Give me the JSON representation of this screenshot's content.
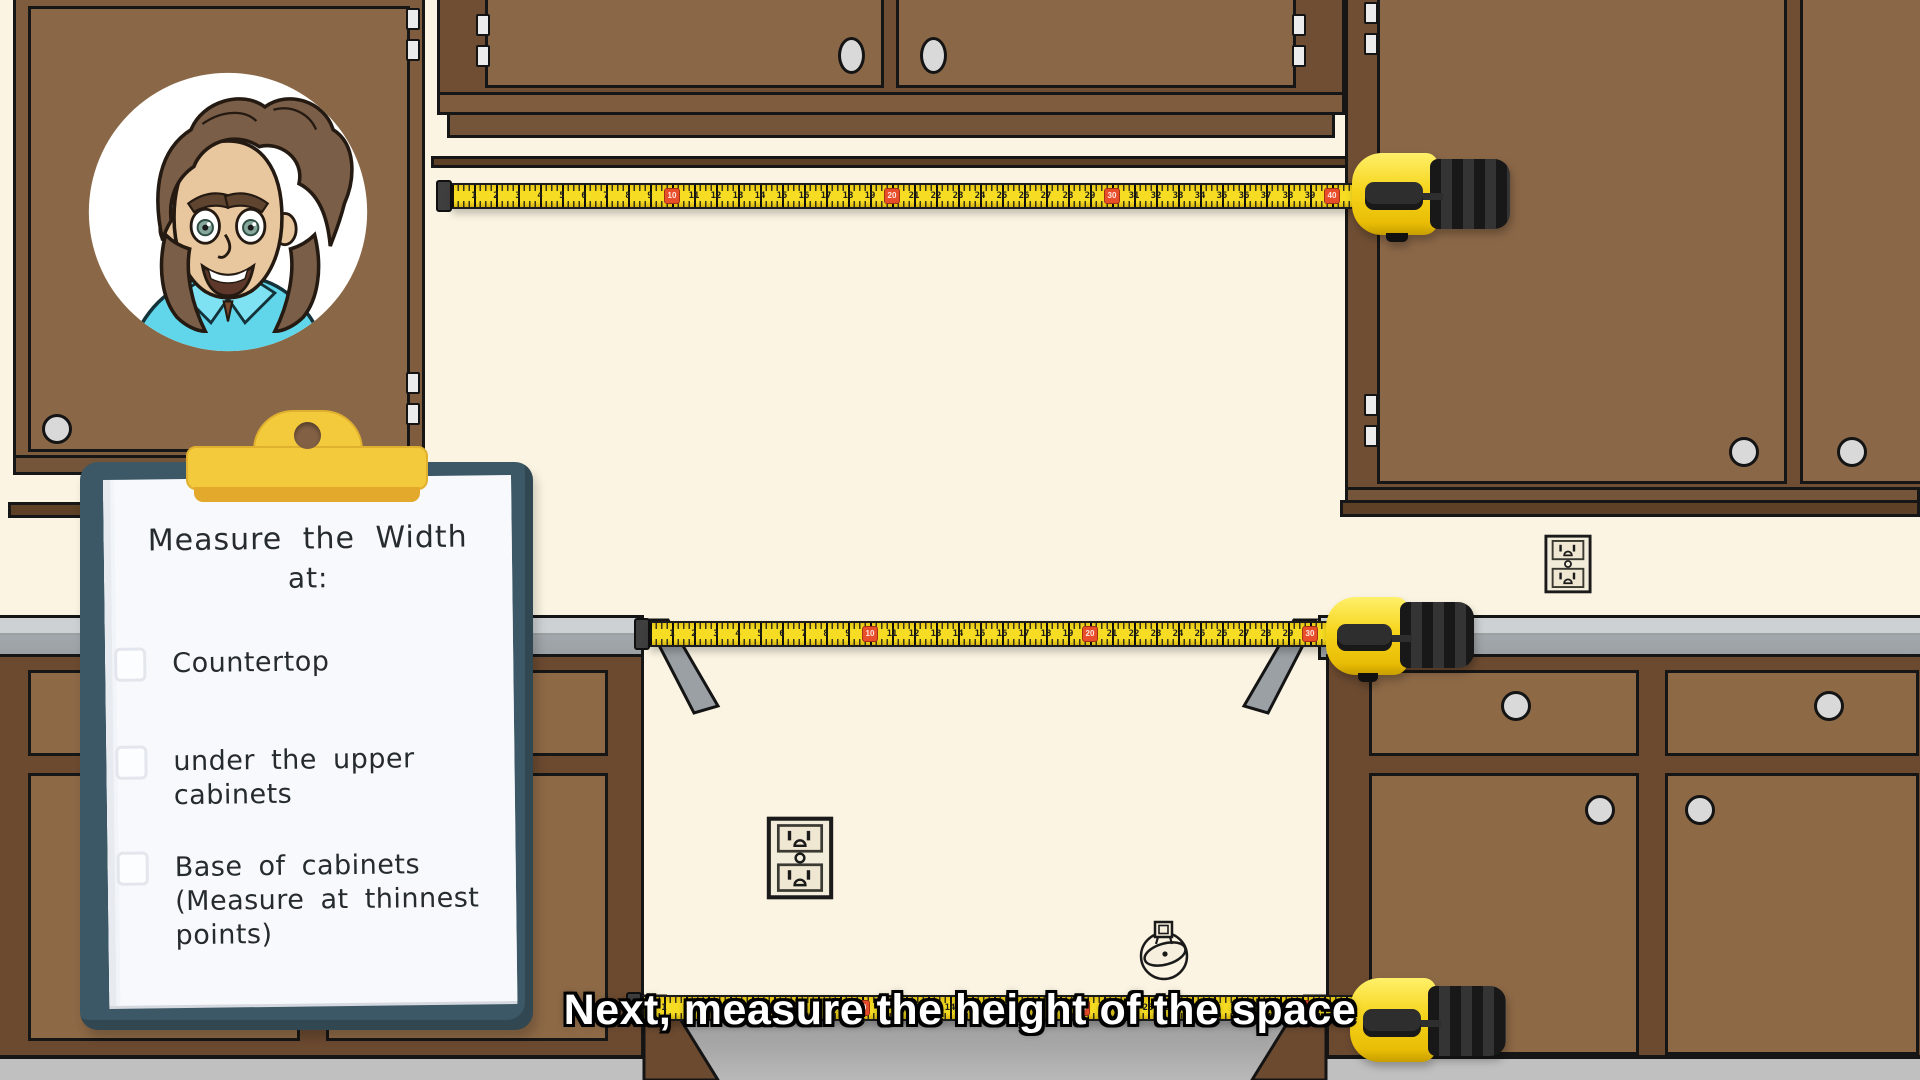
{
  "scene": {
    "caption": "Next, measure the height of the space"
  },
  "clipboard": {
    "title_line1": "Measure the Width",
    "title_line2": "at:",
    "items": [
      {
        "label": "Countertop",
        "checked": false
      },
      {
        "label": "under the upper cabinets",
        "checked": false
      },
      {
        "label": "Base of cabinets (Measure at thinnest points)",
        "checked": false
      }
    ]
  },
  "tapes": [
    {
      "name": "upper-opening-tape",
      "max_inches": 40,
      "red_interval": 10
    },
    {
      "name": "counter-opening-tape",
      "max_inches": 30,
      "red_interval": 10
    },
    {
      "name": "base-opening-tape",
      "max_inches": 31,
      "red_interval": 10
    }
  ],
  "colors": {
    "wall": "#fbf4e2",
    "cabinet_door": "#8a6747",
    "base_cabinet_door": "#8d6946",
    "countertop_gray": "#a2a7ab",
    "floor_gray": "#c0c0c0",
    "tape_yellow": "#f6dc22",
    "tape_marker_red": "#e94e2b",
    "clip_yellow": "#f3ca3c",
    "clipboard_board": "#3c5866",
    "caption_text": "#ffffff"
  }
}
